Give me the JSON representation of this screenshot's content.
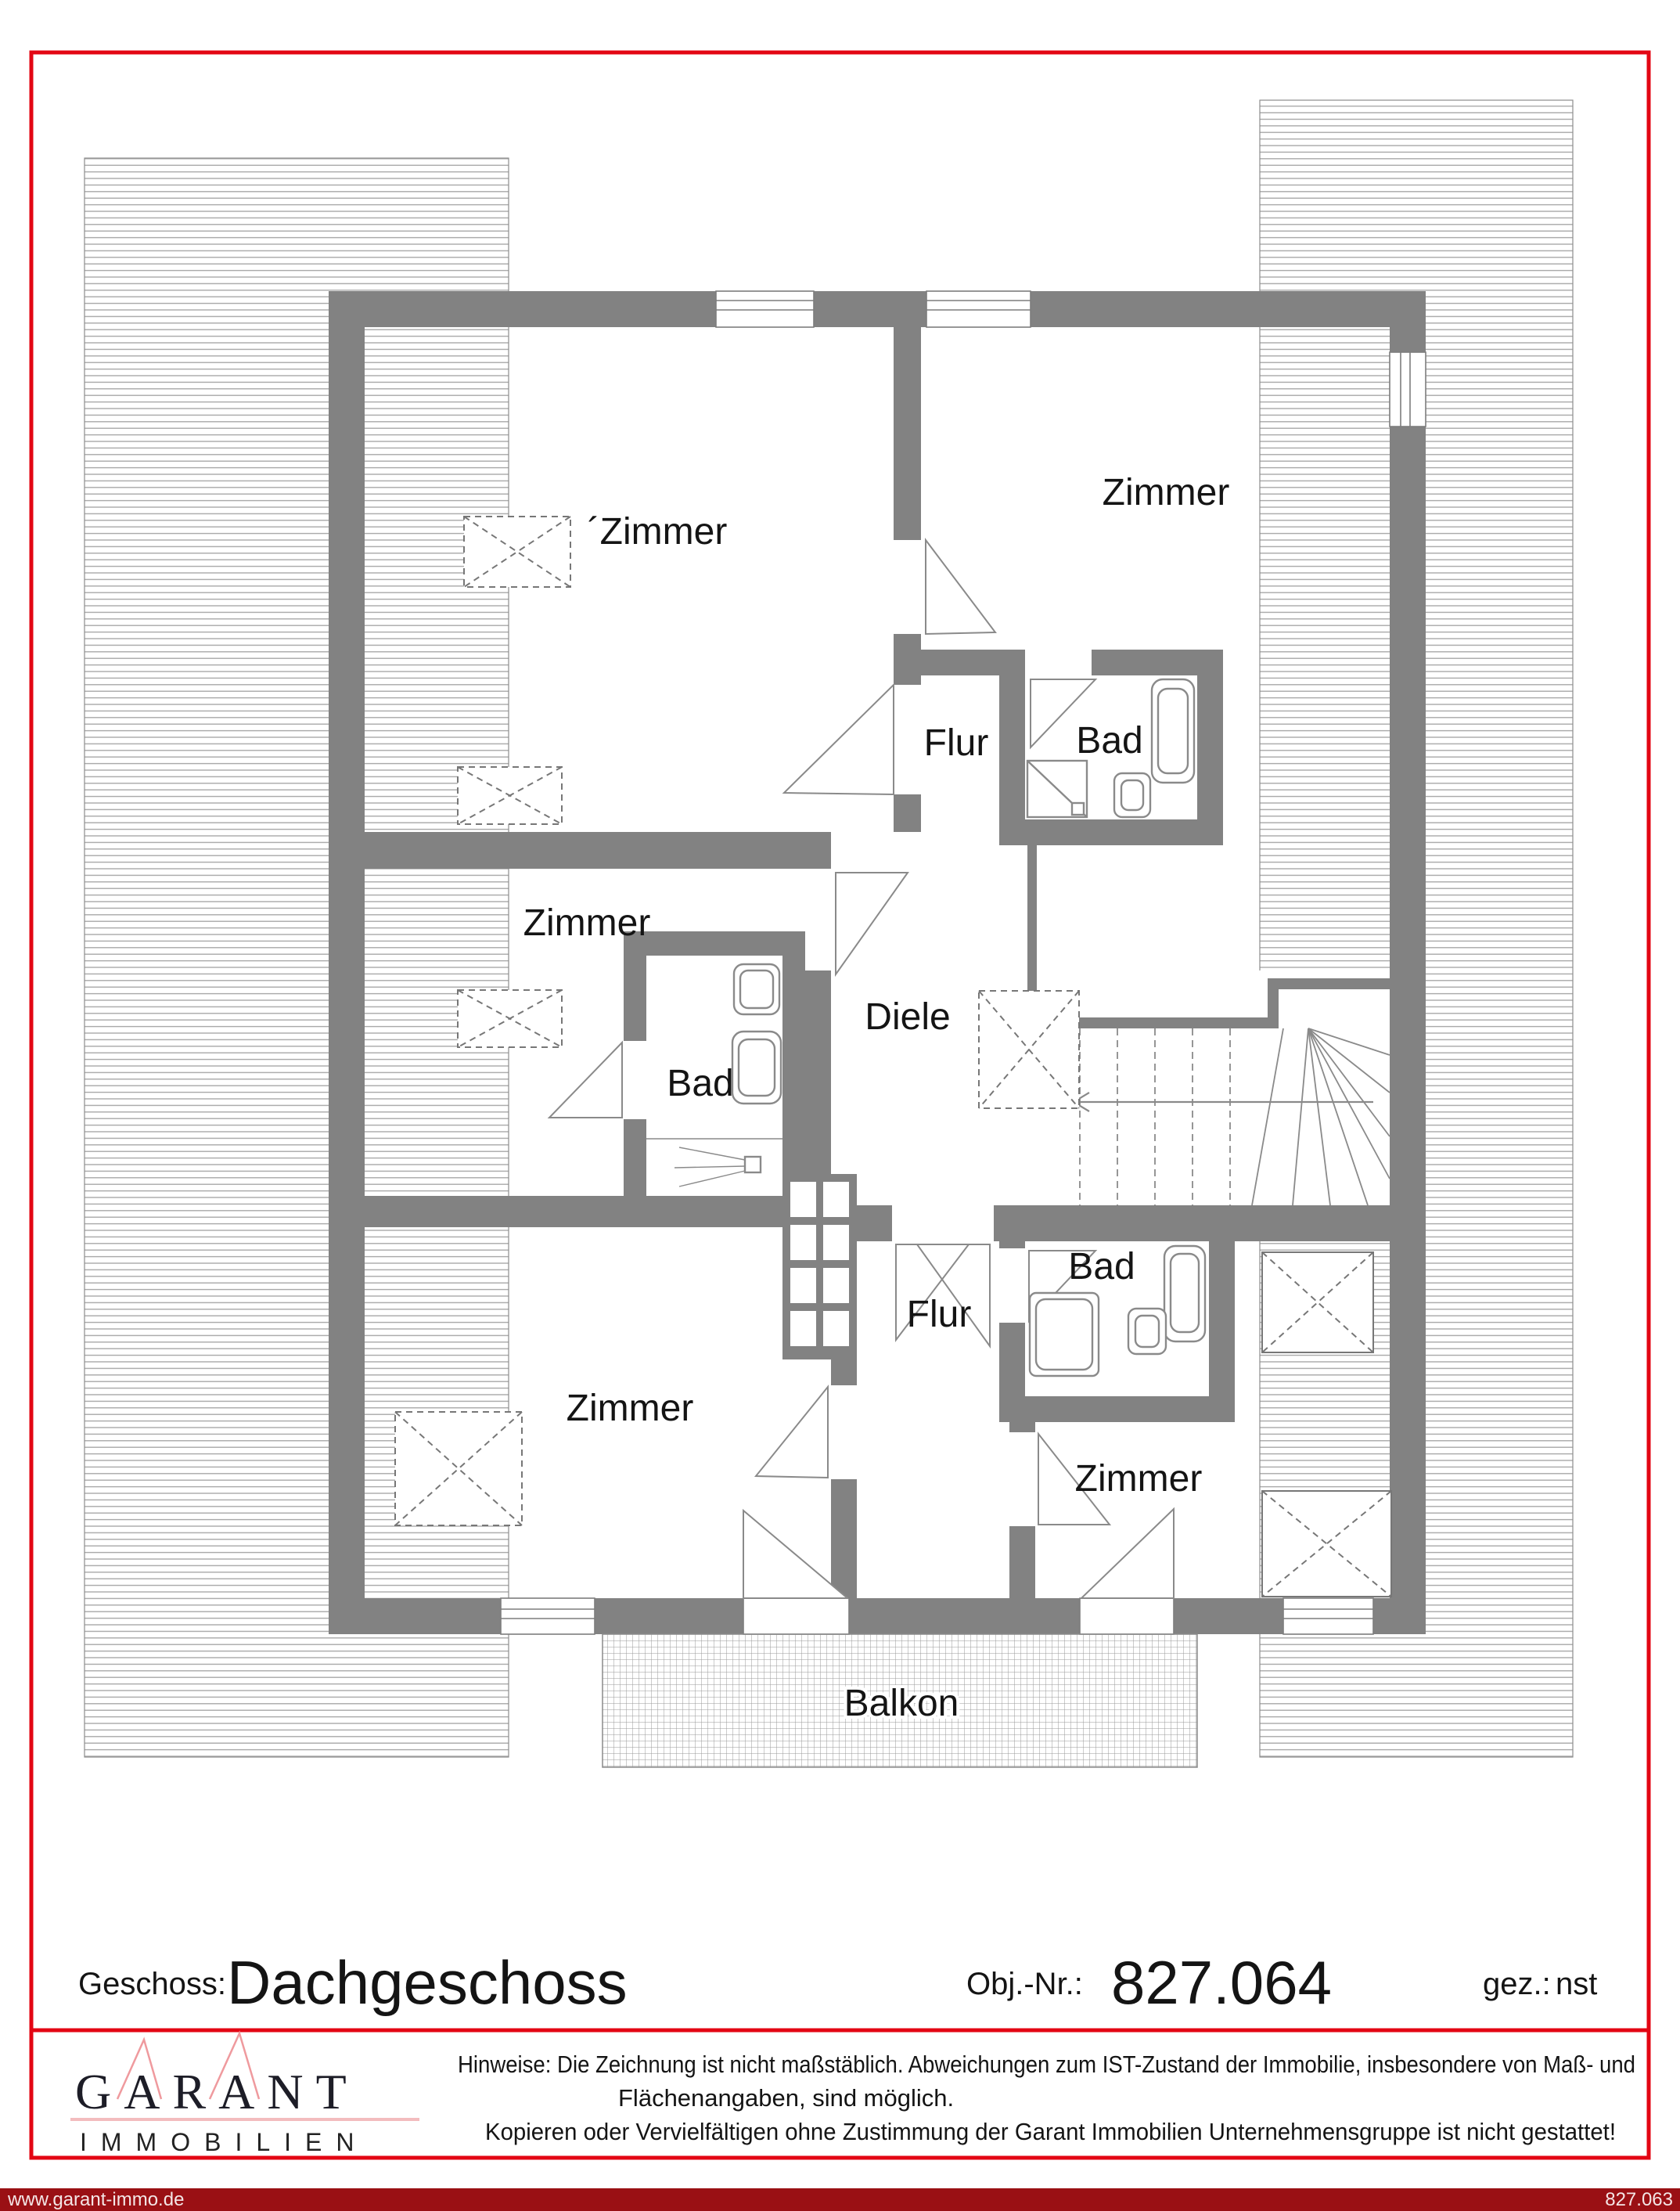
{
  "page": {
    "border_color": "#e30613",
    "bar_color": "#9a1014",
    "wall_color": "#828282"
  },
  "plan": {
    "room_labels": {
      "zimmer_top_left": "´Zimmer",
      "zimmer_top_right": "Zimmer",
      "flur_top": "Flur",
      "bad_top": "Bad",
      "zimmer_mid_left": "Zimmer",
      "bad_mid": "Bad",
      "diele": "Diele",
      "flur_bottom": "Flur",
      "bad_bottom": "Bad",
      "zimmer_bottom_left": "Zimmer",
      "zimmer_bottom_right": "Zimmer",
      "balkon": "Balkon"
    }
  },
  "footer": {
    "geschoss_label": "Geschoss:",
    "geschoss_value": "Dachgeschoss",
    "obj_label": "Obj.-Nr.:",
    "obj_value": "827.064",
    "gez_label": "gez.:",
    "gez_value": "nst"
  },
  "logo": {
    "title": "GARANT",
    "subtitle": "IMMOBILIEN"
  },
  "notice": {
    "line1": "Hinweise: Die Zeichnung ist nicht maßstäblich. Abweichungen zum IST-Zustand der Immobilie, insbesondere von Maß- und",
    "line2": "Flächenangaben, sind möglich.",
    "line3": "Kopieren oder Vervielfältigen ohne Zustimmung der Garant Immobilien Unternehmensgruppe ist nicht gestattet!"
  },
  "bottom_bar": {
    "website": "www.garant-immo.de",
    "object_code": "827.063"
  }
}
